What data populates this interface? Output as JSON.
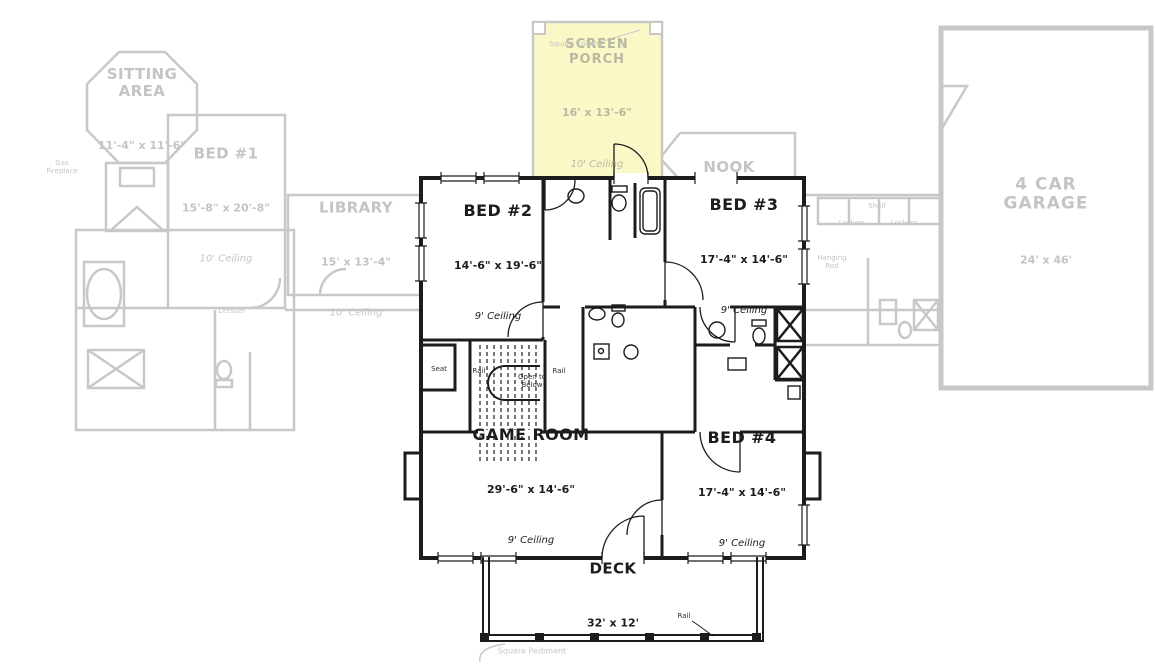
{
  "rooms": {
    "sitting_area": {
      "name": "SITTING\nAREA",
      "dims": "11'-4\" x 11'-6\""
    },
    "bed1": {
      "name": "BED #1",
      "dims": "15'-8\" x 20'-8\"",
      "ceiling": "10' Ceiling"
    },
    "library": {
      "name": "LIBRARY",
      "dims": "15' x 13'-4\"",
      "ceiling": "10' Ceiling"
    },
    "screen_porch": {
      "name": "SCREEN\nPORCH",
      "dims": "16' x 13'-6\"",
      "ceiling": "10' Ceiling"
    },
    "nook": {
      "name": "NOOK"
    },
    "garage": {
      "name": "4 CAR\nGARAGE",
      "dims": "24' x 46'"
    },
    "bed2": {
      "name": "BED #2",
      "dims": "14'-6\" x 19'-6\"",
      "ceiling": "9' Ceiling"
    },
    "bed3": {
      "name": "BED #3",
      "dims": "17'-4\" x 14'-6\"",
      "ceiling": "9' Ceiling"
    },
    "game_room": {
      "name": "GAME ROOM",
      "dims": "29'-6\" x 14'-6\"",
      "ceiling": "9' Ceiling"
    },
    "bed4": {
      "name": "BED #4",
      "dims": "17'-4\" x 14'-6\"",
      "ceiling": "9' Ceiling"
    },
    "deck": {
      "name": "DECK",
      "dims": "32' x 12'"
    }
  },
  "annotations": {
    "square_column": "Square Column",
    "square_pediment": "Square Pediment",
    "open_to_below": "Open to\nBelow",
    "seat": "Seat",
    "rail": "Rail",
    "deck_rail": "Rail",
    "lockers": "Lockers",
    "shelf": "Shelf",
    "hanging_rod": "Hanging\nRod",
    "fireplace": "Gas\nFireplace",
    "dresser": "Dresser"
  },
  "colors": {
    "active_line": "#1c1c1c",
    "ghost_line": "#c8c8c8",
    "porch_fill": "#f9f8c6",
    "background": "#ffffff"
  }
}
